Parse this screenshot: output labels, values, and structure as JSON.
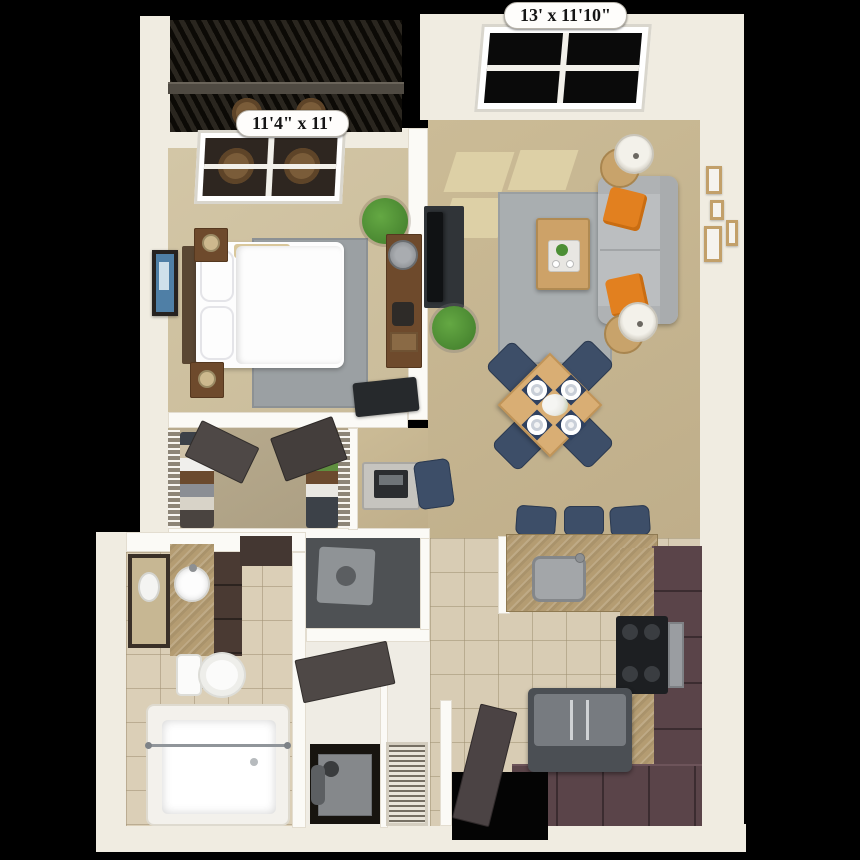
{
  "title": "Apartment 3D floor plan (top view)",
  "background_color": "#000000",
  "labels": {
    "living": "13' x 11'10\"",
    "bedroom": "11'4\" x 11'"
  },
  "palette": {
    "wall_outer": "#f0ece1",
    "wall_inner": "#fbfaf6",
    "carpet_bedroom": "#cfc2a2",
    "carpet_living": "#c5b491",
    "carpet_closet": "#b5a88b",
    "tile_floor": "#d8ccb4",
    "rug_gray": "#9ba0a3",
    "sofa_gray": "#bbbec0",
    "pillow_orange": "#e2801f",
    "chair_navy": "#3d4e68",
    "nightstand_wood": "#6e4a2c",
    "dining_table_wood": "#d9ae74",
    "cabinet_maroon": "#5a4449",
    "countertop_tan": "#b49c72",
    "appliance_gray": "#4b4f54",
    "door_dark": "#4e4846",
    "balcony_dark": "#0c0a06",
    "plant_green": "#4c8f35"
  },
  "rooms": [
    {
      "name": "Bedroom",
      "dimensions": "11'4\" x 11'",
      "furniture": [
        "queen bed with two pillows",
        "headboard",
        "nightstand with lamp (x2)",
        "gray area rug",
        "wall art",
        "dresser with lamp",
        "potted plant",
        "tv"
      ]
    },
    {
      "name": "Living Room",
      "dimensions": "13' x 11'10\"",
      "furniture": [
        "gray sofa with 2 orange pillows",
        "round side table with lamp (x2)",
        "wood coffee table with tray",
        "gray area rug",
        "tv on media console",
        "potted plant",
        "gallery of 4 wall frames",
        "sunlight patches on floor",
        "window"
      ]
    },
    {
      "name": "Dining Area",
      "furniture": [
        "square wood table (diamond orientation)",
        "navy dining chair (x4)",
        "place setting with plate and navy mat (x4)",
        "white flower centerpiece"
      ]
    },
    {
      "name": "Kitchen",
      "furniture": [
        "peninsula counter with stainless sink",
        "navy bar stool (x3)",
        "black cooktop range with oven",
        "french-door refrigerator",
        "L-shaped dark cabinets"
      ]
    },
    {
      "name": "Walk-in Closet",
      "furniture": [
        "wire shelving with hanging clothes (both sides)",
        "dark double doors"
      ]
    },
    {
      "name": "Desk Nook",
      "furniture": [
        "desk with laptop",
        "navy task chair"
      ]
    },
    {
      "name": "Bathroom",
      "furniture": [
        "vanity with round white sink",
        "framed mirror",
        "dark cabinets",
        "toilet",
        "bathtub with shower rod"
      ]
    },
    {
      "name": "Laundry / Utility",
      "furniture": [
        "washer closet",
        "water heater with pipe",
        "louvered closet door",
        "bathroom door (open)"
      ]
    },
    {
      "name": "Balcony",
      "furniture": [
        "dark metal railing",
        "wicker chair (x2)"
      ]
    },
    {
      "name": "Entry",
      "furniture": [
        "entry door (ajar)",
        "doorway opening"
      ]
    }
  ]
}
